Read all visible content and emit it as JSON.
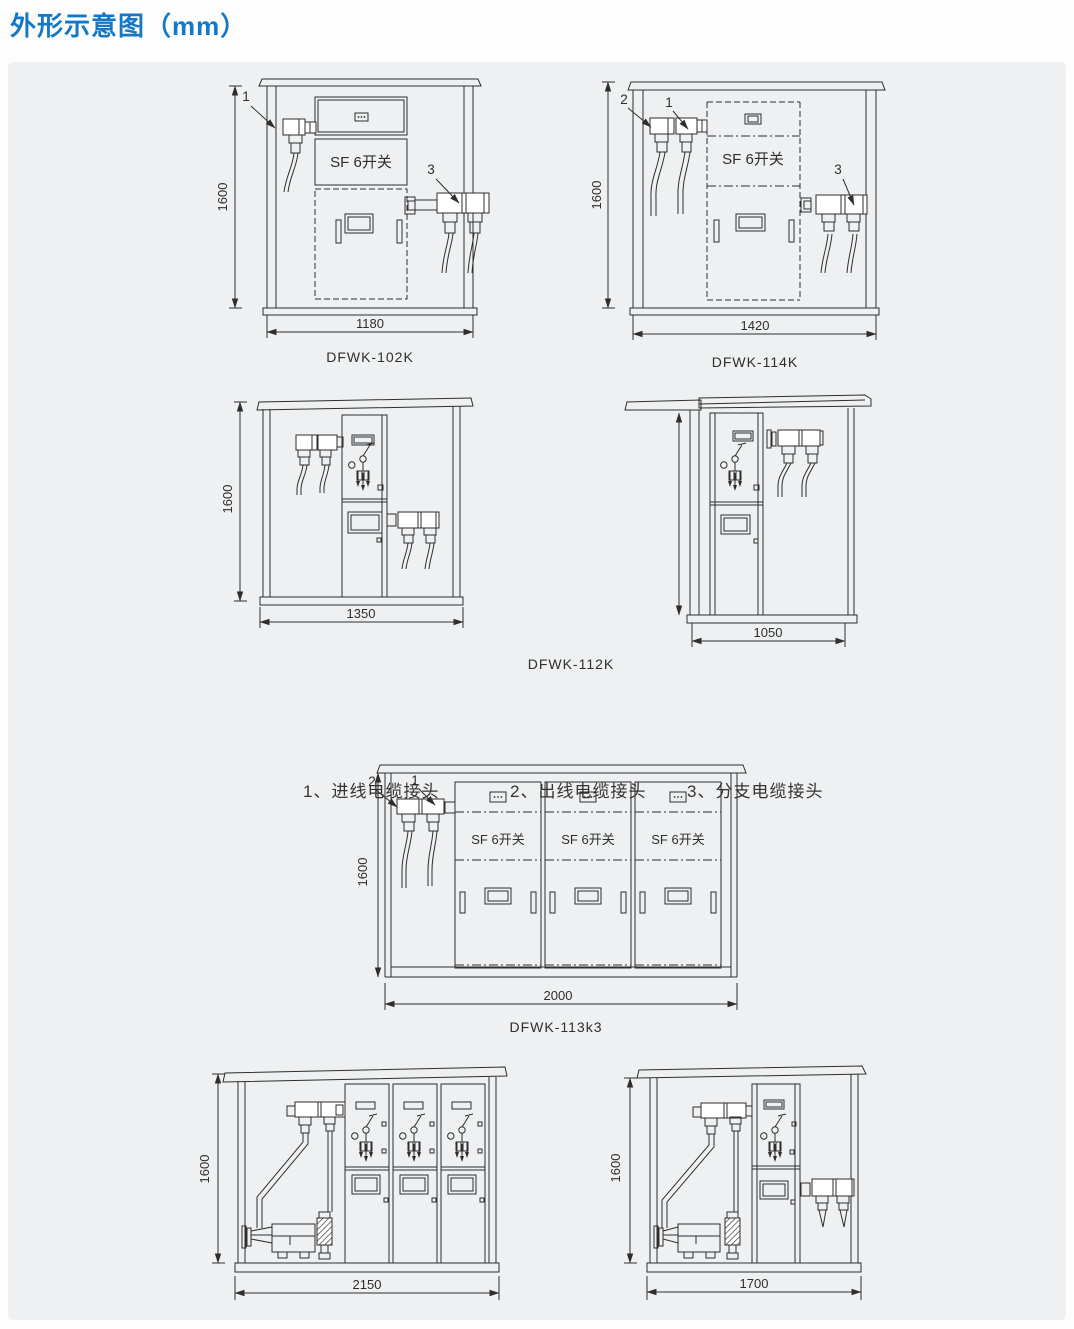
{
  "page": {
    "title": "外形示意图（mm）"
  },
  "legend": {
    "items": [
      {
        "label": "1、进线电缆接头"
      },
      {
        "label": "2、出线电缆接头"
      },
      {
        "label": "3、分支电缆接头"
      }
    ]
  },
  "shared": {
    "sf6_label": "SF 6开关"
  },
  "diagrams": {
    "d102": {
      "model": "DFWK-102K",
      "width_mm": "1180",
      "height_mm": "1600",
      "callout_in": "1",
      "callout_branch": "3"
    },
    "d114": {
      "model": "DFWK-114K",
      "width_mm": "1420",
      "height_mm": "1600",
      "callout_out": "2",
      "callout_in": "1",
      "callout_branch": "3"
    },
    "d112": {
      "model": "DFWK-112K",
      "width_mm": "1350",
      "height_mm": "1600"
    },
    "d112_side": {
      "width_mm": "1050"
    },
    "d113": {
      "model": "DFWK-113k3",
      "width_mm": "2000",
      "height_mm": "1600",
      "callout_out": "2",
      "callout_in": "1"
    },
    "d113_side_a": {
      "width_mm": "2150",
      "height_mm": "1600"
    },
    "d113_side_b": {
      "width_mm": "1700",
      "height_mm": "1600"
    }
  },
  "colors": {
    "title_blue": "#1478c8",
    "panel_bg": "#eef0f1",
    "line": "#2e2e2e"
  }
}
